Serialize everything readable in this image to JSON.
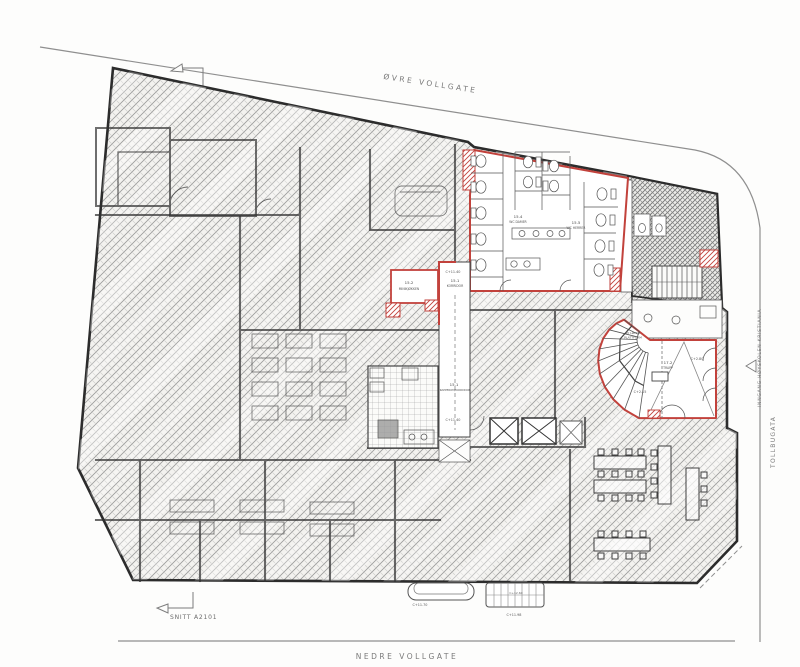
{
  "drawing": {
    "kind": "architectural floor plan"
  },
  "streets": {
    "top": "ØVRE VOLLGATE",
    "bottom": "NEDRE VOLLGATE",
    "right": "TOLLBUGATA",
    "entrance": "INNGANG HØYSKOLEN KRISTIANIA"
  },
  "markers": {
    "section_label": "SNITT A2101"
  },
  "rooms": {
    "korridor_upper": {
      "id": "15.1",
      "name": "KORRIDOR"
    },
    "korridor_lower": {
      "id": "15.1",
      "name": "TRAPPEROM/KORRIDOR"
    },
    "minikjokken": {
      "id": "15.2",
      "name": "MINIKJØKKEN"
    },
    "wc_damer": {
      "id": "15.4",
      "name": "WC DAMER"
    },
    "wc_herrer": {
      "id": "15.5",
      "name": "WC HERRER"
    },
    "trapp": {
      "id": "17.2",
      "name": "TRAPP"
    }
  },
  "annotations": {
    "lift_line1": "NY LØFTE-",
    "lift_line2": "PLATTFORM",
    "elev_korridor_top": "C+11.40",
    "elev_korridor_bottom": "C+11.40",
    "elev_stair_top": "C+2.80",
    "elev_stair_mid": "C+2.15",
    "elev_entry_left": "C+11.70",
    "elev_entry_mid": "C+12.60",
    "elev_entry_right": "C+11.98"
  },
  "colors": {
    "highlight_red": "#c2423c",
    "ink": "#3b3b3b"
  }
}
